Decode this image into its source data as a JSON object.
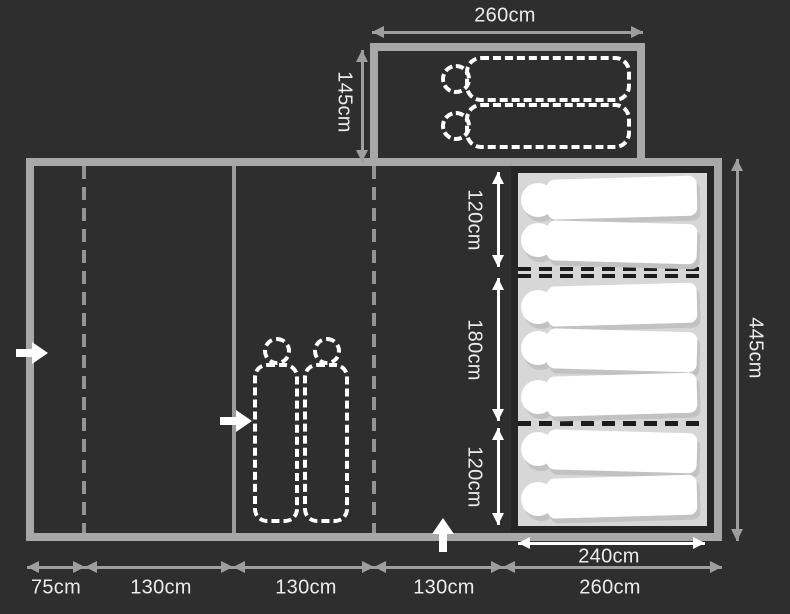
{
  "diagram": {
    "type": "tent-floorplan",
    "colors": {
      "background": "#2e2e2e",
      "wall": "#a8a8a8",
      "mat": "#d7d7d7",
      "mat_border": "#262626",
      "dimension_gray": "#9e9e9e",
      "white": "#ffffff"
    },
    "annex": {
      "width_label": "260cm",
      "depth_label": "145cm",
      "sleeping_bag_count": 2,
      "sleeping_bag_style": "dashed-outline-horizontal"
    },
    "main_tent": {
      "height_label": "445cm",
      "entrance_count": 3,
      "living_area_sleeping_bag_count": 2,
      "living_area_sleeping_bag_style": "dashed-outline-vertical"
    },
    "bedroom": {
      "width_label": "240cm",
      "sections": [
        {
          "depth_label": "120cm",
          "sleeping_bag_count": 2
        },
        {
          "depth_label": "180cm",
          "sleeping_bag_count": 3
        },
        {
          "depth_label": "120cm",
          "sleeping_bag_count": 2
        }
      ]
    },
    "bottom_dimensions": {
      "labels": [
        "75cm",
        "130cm",
        "130cm",
        "130cm",
        "260cm"
      ]
    }
  }
}
